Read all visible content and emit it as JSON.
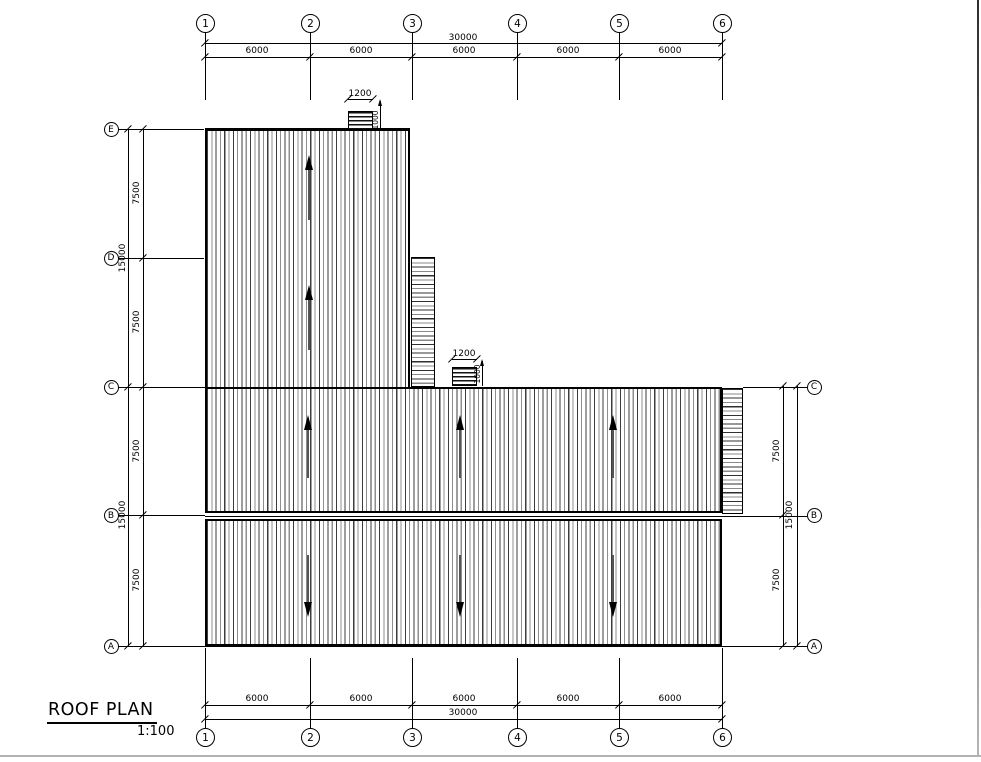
{
  "drawing": {
    "title": "ROOF PLAN",
    "scale": "1:100"
  },
  "grid": {
    "columns": [
      "1",
      "2",
      "3",
      "4",
      "5",
      "6"
    ],
    "rows_left": [
      "E",
      "D",
      "C",
      "B",
      "A"
    ],
    "rows_right": [
      "C",
      "B",
      "A"
    ]
  },
  "dims": {
    "top_total": "30000",
    "top_segments": [
      "6000",
      "6000",
      "6000",
      "6000",
      "6000"
    ],
    "bottom_total": "30000",
    "bottom_segments": [
      "6000",
      "6000",
      "6000",
      "6000",
      "6000"
    ],
    "left_segments": [
      "7500",
      "7500",
      "7500",
      "7500"
    ],
    "left_totals": [
      "15000",
      "15000"
    ],
    "right_segments": [
      "7500",
      "7500"
    ],
    "right_total": "15000"
  },
  "vents": [
    {
      "width": "1200",
      "height": "1000"
    },
    {
      "width": "1200",
      "height": "1000"
    }
  ],
  "colors": {
    "ink": "#000000",
    "hatch_dark": "#3d3d3d",
    "hatch_light": "#8f8f8f"
  }
}
